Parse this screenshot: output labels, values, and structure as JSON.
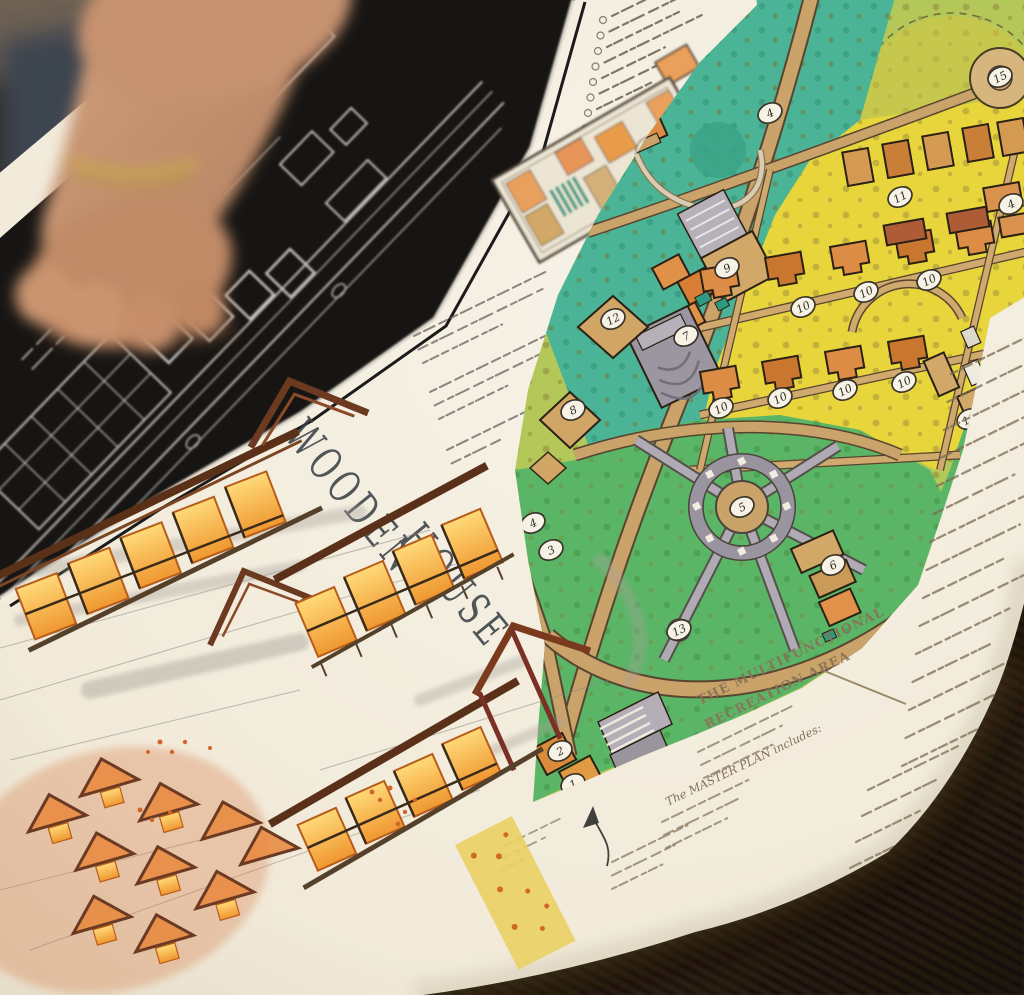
{
  "poster": {
    "title": {
      "line1": "WOODEN",
      "line2": "HOUSE"
    },
    "headings": {
      "recreation_area_line1": "THE MULTIFUNCTIONAL",
      "recreation_area_line2": "RECREATION AREA",
      "master_plan_note": "The MASTER PLAN includes:"
    },
    "map": {
      "markers": [
        {
          "label": "4",
          "x": 770,
          "y": 113
        },
        {
          "label": "15",
          "x": 1000,
          "y": 77
        },
        {
          "label": "11",
          "x": 900,
          "y": 197
        },
        {
          "label": "4",
          "x": 1011,
          "y": 204
        },
        {
          "label": "9",
          "x": 727,
          "y": 268
        },
        {
          "label": "12",
          "x": 613,
          "y": 319
        },
        {
          "label": "7",
          "x": 686,
          "y": 336
        },
        {
          "label": "8",
          "x": 573,
          "y": 410
        },
        {
          "label": "10",
          "x": 803,
          "y": 307
        },
        {
          "label": "10",
          "x": 866,
          "y": 292
        },
        {
          "label": "10",
          "x": 929,
          "y": 280
        },
        {
          "label": "10",
          "x": 721,
          "y": 408
        },
        {
          "label": "10",
          "x": 780,
          "y": 398
        },
        {
          "label": "10",
          "x": 845,
          "y": 390
        },
        {
          "label": "10",
          "x": 904,
          "y": 382
        },
        {
          "label": "5",
          "x": 742,
          "y": 507
        },
        {
          "label": "6",
          "x": 833,
          "y": 565
        },
        {
          "label": "13",
          "x": 679,
          "y": 630
        },
        {
          "label": "4",
          "x": 533,
          "y": 523
        },
        {
          "label": "3",
          "x": 551,
          "y": 550
        },
        {
          "label": "11",
          "x": 969,
          "y": 419
        },
        {
          "label": "2",
          "x": 560,
          "y": 751
        },
        {
          "label": "1",
          "x": 573,
          "y": 784
        }
      ]
    },
    "colors": {
      "paper": "#f2ecdf",
      "band": "#171513",
      "teal": "#4cb496",
      "leaf_green": "#b3c858",
      "yellow": "#e8d53c",
      "park_green": "#5ab566",
      "path_tan": "#c9a36a",
      "building_orange": "#e08b42",
      "plaza_gray": "#a8a2ac"
    }
  }
}
